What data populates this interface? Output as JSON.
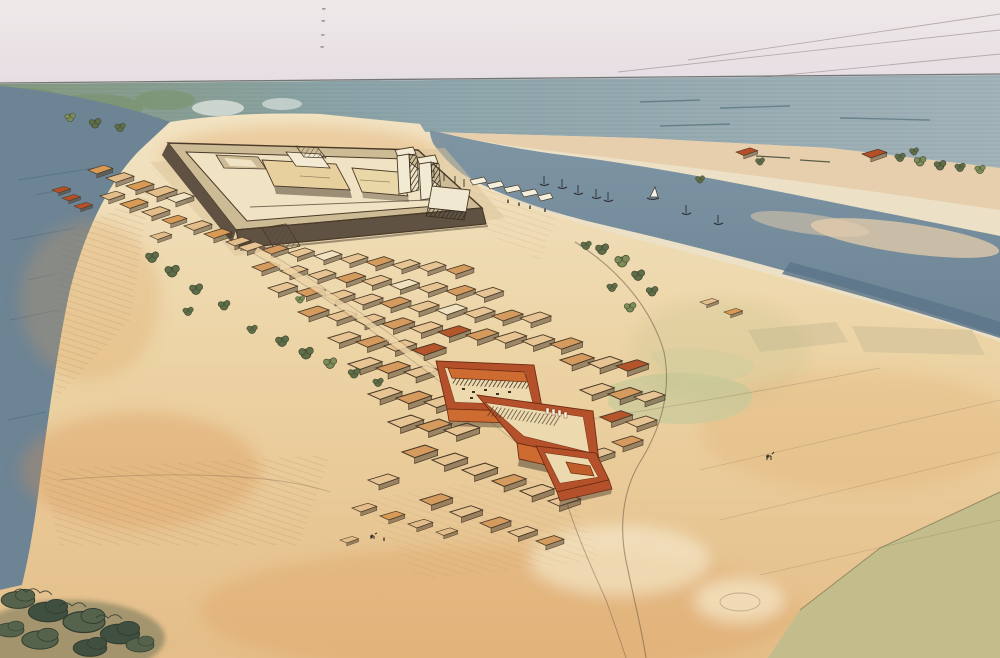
{
  "meta": {
    "description": "Watercolor and ink aerial reconstruction of an ancient walled river-island settlement: a large hatched citadel enclosure with gate pylons, a dense mud-brick town with three red-walled temple courtyards, rivers on both sides with small boats, sandy slopes, trees, fields and a plowed furrow field at lower right",
    "medium_note": "pen-and-ink with watercolor wash"
  },
  "palette": {
    "sky1": "#efe9e9",
    "sky2": "#e5dde2",
    "horizon": "#5f6462",
    "sea1": "#86997e",
    "sea2": "#8ba4a9",
    "sea3": "#a3b3ba",
    "seaGreen": "#7c9472",
    "water1": "#7e95a4",
    "water2": "#6d8495",
    "waterDark": "#5d7689",
    "waterStroke": "#3f617a",
    "farPlain": "#e7ceac",
    "sand1": "#f2e4c4",
    "sand2": "#ecd3a4",
    "sand3": "#e4bd88",
    "sandWarm": "#dd9a55",
    "sandOrange": "#d98f4e",
    "sandPale": "#f7ecd2",
    "ink": "#4a3a28",
    "pathInk": "#6a5742",
    "wallBase": "#cdbb96",
    "wallFace": "#5f5242",
    "floorCream": "#efe3c4",
    "blockTan": "#e7cf9e",
    "towerWhite": "#f2ead2",
    "red": "#b5512a",
    "redBright": "#cd6b30",
    "redDark": "#6e2d14",
    "court": "#ecd9ae",
    "fieldGreen": "#c2bd8c",
    "fieldPale": "#d9c79e",
    "greenPatch": "#c9c99b",
    "treeGreen": "#5f6e49",
    "treeDark": "#46523a",
    "shrub": "#55634d"
  },
  "palette_lists": {
    "houseFills": [
      "#e6c493",
      "#d49a5e",
      "#f0e2c0",
      "#c78b4d",
      "#b5552c"
    ],
    "hutFills": [
      "#e2bd8a",
      "#d89a55",
      "#f0e3c4",
      "#c98a4a",
      "#b44f28"
    ],
    "treeFills": [
      "#5f6e49",
      "#7e8c58"
    ],
    "shrubFills": [
      "#55634d",
      "#3f4f40"
    ]
  },
  "scene": {
    "houses": [
      [
        238,
        247,
        0.85,
        0
      ],
      [
        262,
        250,
        0.85,
        1
      ],
      [
        288,
        253,
        0.85,
        0
      ],
      [
        314,
        256,
        0.9,
        2
      ],
      [
        340,
        259,
        0.9,
        0
      ],
      [
        366,
        262,
        0.9,
        1
      ],
      [
        392,
        265,
        0.9,
        0
      ],
      [
        418,
        267,
        0.9,
        0
      ],
      [
        446,
        270,
        0.9,
        1
      ],
      [
        252,
        267,
        0.9,
        1
      ],
      [
        280,
        271,
        0.9,
        0
      ],
      [
        308,
        275,
        0.9,
        0
      ],
      [
        336,
        278,
        0.95,
        1
      ],
      [
        362,
        281,
        0.95,
        0
      ],
      [
        390,
        285,
        0.95,
        2
      ],
      [
        418,
        288,
        0.95,
        0
      ],
      [
        446,
        291,
        0.95,
        1
      ],
      [
        474,
        293,
        0.95,
        0
      ],
      [
        268,
        288,
        0.95,
        0
      ],
      [
        296,
        292,
        0.95,
        1
      ],
      [
        324,
        296,
        1,
        0
      ],
      [
        352,
        300,
        1,
        0
      ],
      [
        380,
        303,
        1,
        1
      ],
      [
        408,
        307,
        1,
        0
      ],
      [
        436,
        310,
        1,
        2
      ],
      [
        464,
        313,
        1,
        0
      ],
      [
        492,
        316,
        1,
        1
      ],
      [
        520,
        318,
        1,
        0
      ],
      [
        298,
        312,
        1,
        1
      ],
      [
        326,
        316,
        1,
        0
      ],
      [
        354,
        320,
        1,
        0
      ],
      [
        382,
        324,
        1.05,
        1
      ],
      [
        410,
        328,
        1.05,
        0
      ],
      [
        438,
        332,
        1.05,
        4
      ],
      [
        466,
        335,
        1.05,
        1
      ],
      [
        494,
        338,
        1.05,
        0
      ],
      [
        522,
        341,
        1.05,
        0
      ],
      [
        550,
        344,
        1.05,
        1
      ],
      [
        328,
        338,
        1.05,
        0
      ],
      [
        356,
        342,
        1.05,
        1
      ],
      [
        384,
        346,
        1.05,
        0
      ],
      [
        412,
        350,
        1.1,
        4
      ],
      [
        560,
        360,
        1.1,
        1
      ],
      [
        588,
        363,
        1.1,
        0
      ],
      [
        616,
        366,
        1.05,
        4
      ],
      [
        348,
        364,
        1.1,
        0
      ],
      [
        376,
        368,
        1.1,
        1
      ],
      [
        404,
        372,
        1.1,
        0
      ],
      [
        580,
        390,
        1.1,
        0
      ],
      [
        608,
        394,
        1.1,
        1
      ],
      [
        634,
        397,
        1,
        0
      ],
      [
        368,
        394,
        1.1,
        0
      ],
      [
        396,
        398,
        1.15,
        1
      ],
      [
        424,
        402,
        1.15,
        0
      ],
      [
        600,
        417,
        1.05,
        4
      ],
      [
        626,
        422,
        1,
        0
      ],
      [
        388,
        422,
        1.15,
        0
      ],
      [
        416,
        426,
        1.15,
        1
      ],
      [
        444,
        430,
        1.15,
        0
      ],
      [
        612,
        442,
        1,
        1
      ],
      [
        584,
        454,
        1,
        0
      ],
      [
        402,
        452,
        1.15,
        1
      ],
      [
        432,
        460,
        1.15,
        0
      ],
      [
        462,
        470,
        1.15,
        0
      ],
      [
        492,
        481,
        1.1,
        1
      ],
      [
        520,
        491,
        1.1,
        0
      ],
      [
        548,
        501,
        1.05,
        0
      ],
      [
        420,
        500,
        1.05,
        1
      ],
      [
        450,
        512,
        1.05,
        0
      ],
      [
        480,
        523,
        1,
        1
      ],
      [
        368,
        480,
        1,
        0
      ],
      [
        508,
        532,
        0.95,
        0
      ],
      [
        536,
        541,
        0.9,
        1
      ]
    ],
    "huts": [
      [
        88,
        170,
        0.8,
        1
      ],
      [
        106,
        178,
        0.9,
        0
      ],
      [
        126,
        186,
        0.9,
        1
      ],
      [
        146,
        192,
        1,
        0
      ],
      [
        166,
        198,
        0.9,
        2
      ],
      [
        100,
        196,
        0.8,
        0
      ],
      [
        120,
        204,
        0.9,
        1
      ],
      [
        142,
        212,
        0.9,
        0
      ],
      [
        162,
        220,
        0.8,
        1
      ],
      [
        184,
        226,
        0.9,
        0
      ],
      [
        52,
        190,
        0.6,
        4
      ],
      [
        62,
        198,
        0.6,
        4
      ],
      [
        74,
        206,
        0.6,
        4
      ],
      [
        204,
        234,
        0.9,
        1
      ],
      [
        226,
        242,
        0.8,
        0
      ],
      [
        150,
        236,
        0.7,
        0
      ],
      [
        352,
        508,
        0.8,
        0
      ],
      [
        380,
        516,
        0.8,
        1
      ],
      [
        408,
        524,
        0.8,
        0
      ],
      [
        436,
        532,
        0.7,
        0
      ],
      [
        340,
        540,
        0.6,
        0
      ],
      [
        736,
        152,
        0.7,
        4
      ],
      [
        862,
        154,
        0.8,
        4
      ],
      [
        700,
        302,
        0.6,
        0
      ],
      [
        724,
        312,
        0.6,
        1
      ]
    ],
    "trees": [
      [
        152,
        258,
        1,
        0
      ],
      [
        172,
        272,
        1.1,
        0
      ],
      [
        196,
        290,
        1,
        0
      ],
      [
        224,
        306,
        0.9,
        0
      ],
      [
        188,
        312,
        0.8,
        0
      ],
      [
        282,
        342,
        1,
        0
      ],
      [
        306,
        354,
        1.1,
        0
      ],
      [
        330,
        364,
        1,
        1
      ],
      [
        354,
        374,
        0.9,
        0
      ],
      [
        378,
        383,
        0.8,
        0
      ],
      [
        300,
        300,
        0.7,
        1
      ],
      [
        252,
        330,
        0.8,
        0
      ],
      [
        602,
        250,
        1,
        0
      ],
      [
        622,
        262,
        1.1,
        1
      ],
      [
        638,
        276,
        1,
        0
      ],
      [
        652,
        292,
        0.9,
        0
      ],
      [
        612,
        288,
        0.8,
        0
      ],
      [
        630,
        308,
        0.9,
        1
      ],
      [
        586,
        246,
        0.8,
        0
      ],
      [
        700,
        180,
        0.7,
        0
      ],
      [
        760,
        162,
        0.7,
        0
      ],
      [
        70,
        118,
        0.8,
        1
      ],
      [
        95,
        124,
        0.9,
        0
      ],
      [
        120,
        128,
        0.8,
        0
      ],
      [
        900,
        158,
        0.8,
        0
      ],
      [
        920,
        162,
        0.9,
        1
      ],
      [
        940,
        166,
        0.9,
        0
      ],
      [
        960,
        168,
        0.8,
        0
      ],
      [
        980,
        170,
        0.8,
        1
      ],
      [
        914,
        152,
        0.7,
        0
      ]
    ],
    "shrubs": [
      [
        18,
        600,
        1.2,
        0
      ],
      [
        48,
        612,
        1.4,
        1
      ],
      [
        84,
        622,
        1.5,
        0
      ],
      [
        120,
        634,
        1.4,
        1
      ],
      [
        40,
        640,
        1.3,
        0
      ],
      [
        90,
        648,
        1.2,
        1
      ],
      [
        10,
        630,
        1,
        0
      ],
      [
        140,
        645,
        1,
        0
      ]
    ],
    "boats": [
      [
        544,
        184
      ],
      [
        562,
        187
      ],
      [
        578,
        193
      ],
      [
        596,
        197
      ],
      [
        686,
        213
      ],
      [
        718,
        223
      ],
      [
        608,
        200
      ]
    ],
    "figures": [
      [
        372,
        538
      ],
      [
        384,
        541
      ],
      [
        768,
        458
      ],
      [
        508,
        203
      ],
      [
        519,
        206
      ],
      [
        530,
        209
      ],
      [
        545,
        212
      ]
    ],
    "sky_lines": [
      [
        618,
        72,
        1000,
        30
      ],
      [
        688,
        60,
        1000,
        14
      ],
      [
        755,
        78,
        1000,
        54
      ]
    ],
    "pencil_marks": [
      [
        286,
        8
      ],
      [
        298,
        6
      ],
      [
        310,
        7
      ],
      [
        322,
        5
      ],
      [
        334,
        6
      ],
      [
        348,
        7
      ],
      [
        360,
        8
      ]
    ]
  }
}
